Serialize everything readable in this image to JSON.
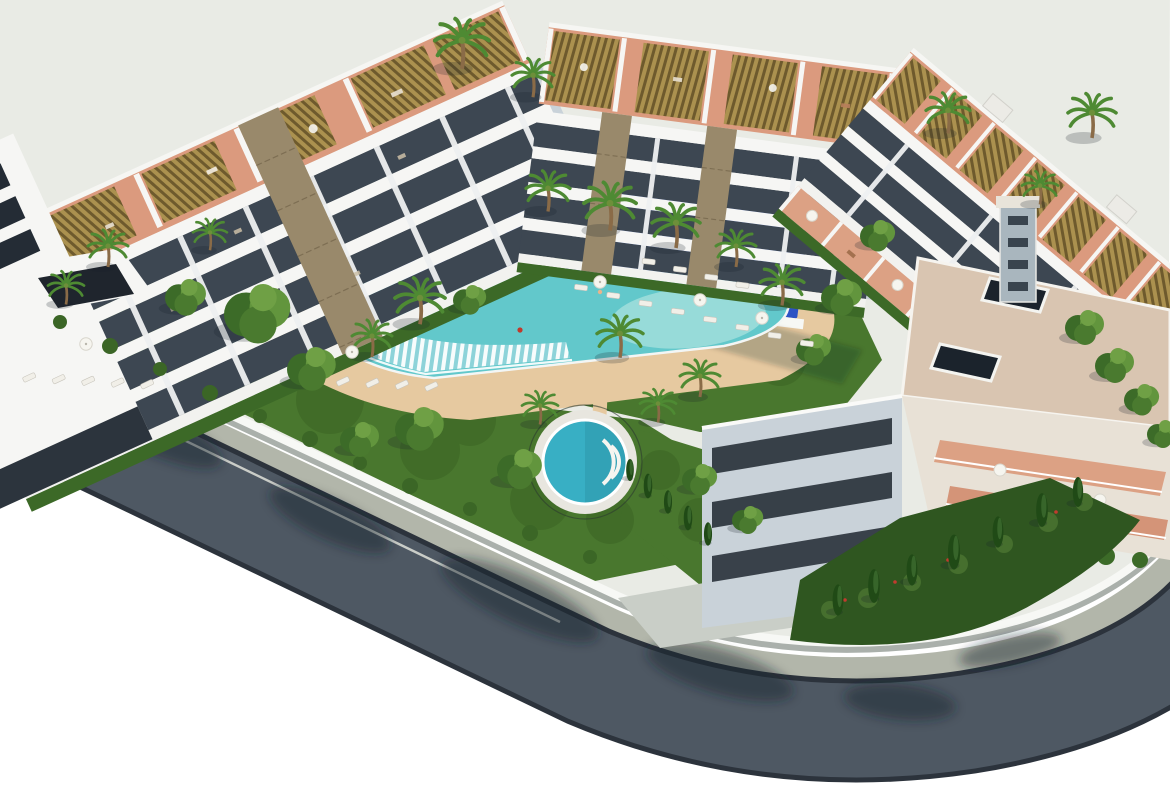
{
  "meta": {
    "description": "Aerial 3D architectural rendering of a modern white apartment complex: three residential blocks with rooftop pergolas and terracotta roof terraces around a landscaped courtyard with a lagoon-style swimming pool, circular spa, kidney-shaped kids pool, blue padel courts, palm gardens, underground garage ramp and a curving perimeter road with sidewalk on a white background",
    "style": "photorealistic CGI, isometric aerial view, white background"
  },
  "colors": {
    "bg": "#ffffff",
    "asphalt": "#4e5863",
    "sidewalk": "#b2b6aa",
    "curb": "#2c333c",
    "lane": "#d8dad3",
    "wall": "#f7f8f5",
    "wall_shadow": "#aab0ab",
    "ground": "#e9ebe5",
    "lawn": "#49772e",
    "lawn_dark": "#335a1d",
    "sand": "#e6c9a0",
    "sand_light": "#f0ddbd",
    "pool_rim": "#f3f6f5",
    "pool_deep": "#16338c",
    "pool_blue": "#2e64c2",
    "pool_turquoise": "#62c8cb",
    "pool_pale": "#a5e0dc",
    "cascade_b": "#8fd4da",
    "spa_water": "#38afc4",
    "kids_water": "#c7ece5",
    "court": "#2d53c4",
    "court_light": "#5277d8",
    "court_pale": "#cfd9f4",
    "building": "#f6f6f4",
    "building_shade": "#c9d2d9",
    "glass": "#3d4752",
    "glass_dark": "#242c35",
    "terracotta": "#db9a7e",
    "terrace_pink": "#dca184",
    "pergola_gold": "#ab914f",
    "pergola_dark": "#6e5a2d",
    "stone": "#99896b",
    "stone_dark": "#7d6e53",
    "roof_beige": "#d9c5b1",
    "hedge": "#3c6927",
    "tree": "#3c6b28",
    "tree_light": "#62953d",
    "palm": "#4e8a33",
    "cypress": "#204a16",
    "trunk": "#8a6b47",
    "shadow": "rgba(22,30,42,0.45)",
    "shadow_soft": "rgba(22,30,42,0.22)",
    "parasol": "#f6f5ef",
    "lounger": "#f1efe8"
  },
  "scene": {
    "background": "white",
    "buildings": [
      {
        "id": "building-a",
        "label": "west residential block, 4 floors, glass balcony bands, stone-clad pier, rooftop pergolas over terracotta terraces"
      },
      {
        "id": "building-b",
        "label": "north residential block, 4 floors, two stone piers, rooftop pergolas"
      },
      {
        "id": "building-c",
        "label": "east wing with row of golden rooftop pergolas, terracotta terraces, corner block with beige flat roof, dark skylights and stair core"
      }
    ],
    "amenities": [
      {
        "id": "lagoon-pool",
        "label": "lagoon swimming pool with navy deep lane, turquoise shallows and striped cascade edge"
      },
      {
        "id": "spa-pool",
        "label": "circular spa pool with steps"
      },
      {
        "id": "kids-pool",
        "label": "kidney-shaped children's pool"
      },
      {
        "id": "padel-courts",
        "label": "blue padel / play courts behind white wall"
      },
      {
        "id": "sun-deck",
        "label": "sand-coloured deck with white sun loungers and parasols"
      },
      {
        "id": "gardens",
        "label": "lawns with palms, leafy trees, cypresses and shrub beds"
      },
      {
        "id": "garage-entrance",
        "label": "underground garage ramp with concrete apron"
      }
    ],
    "roads": [
      {
        "id": "perimeter-road",
        "label": "dark asphalt road with light sidewalk curving around the plot corner, tree shadows across the surface, white edge line"
      }
    ]
  }
}
